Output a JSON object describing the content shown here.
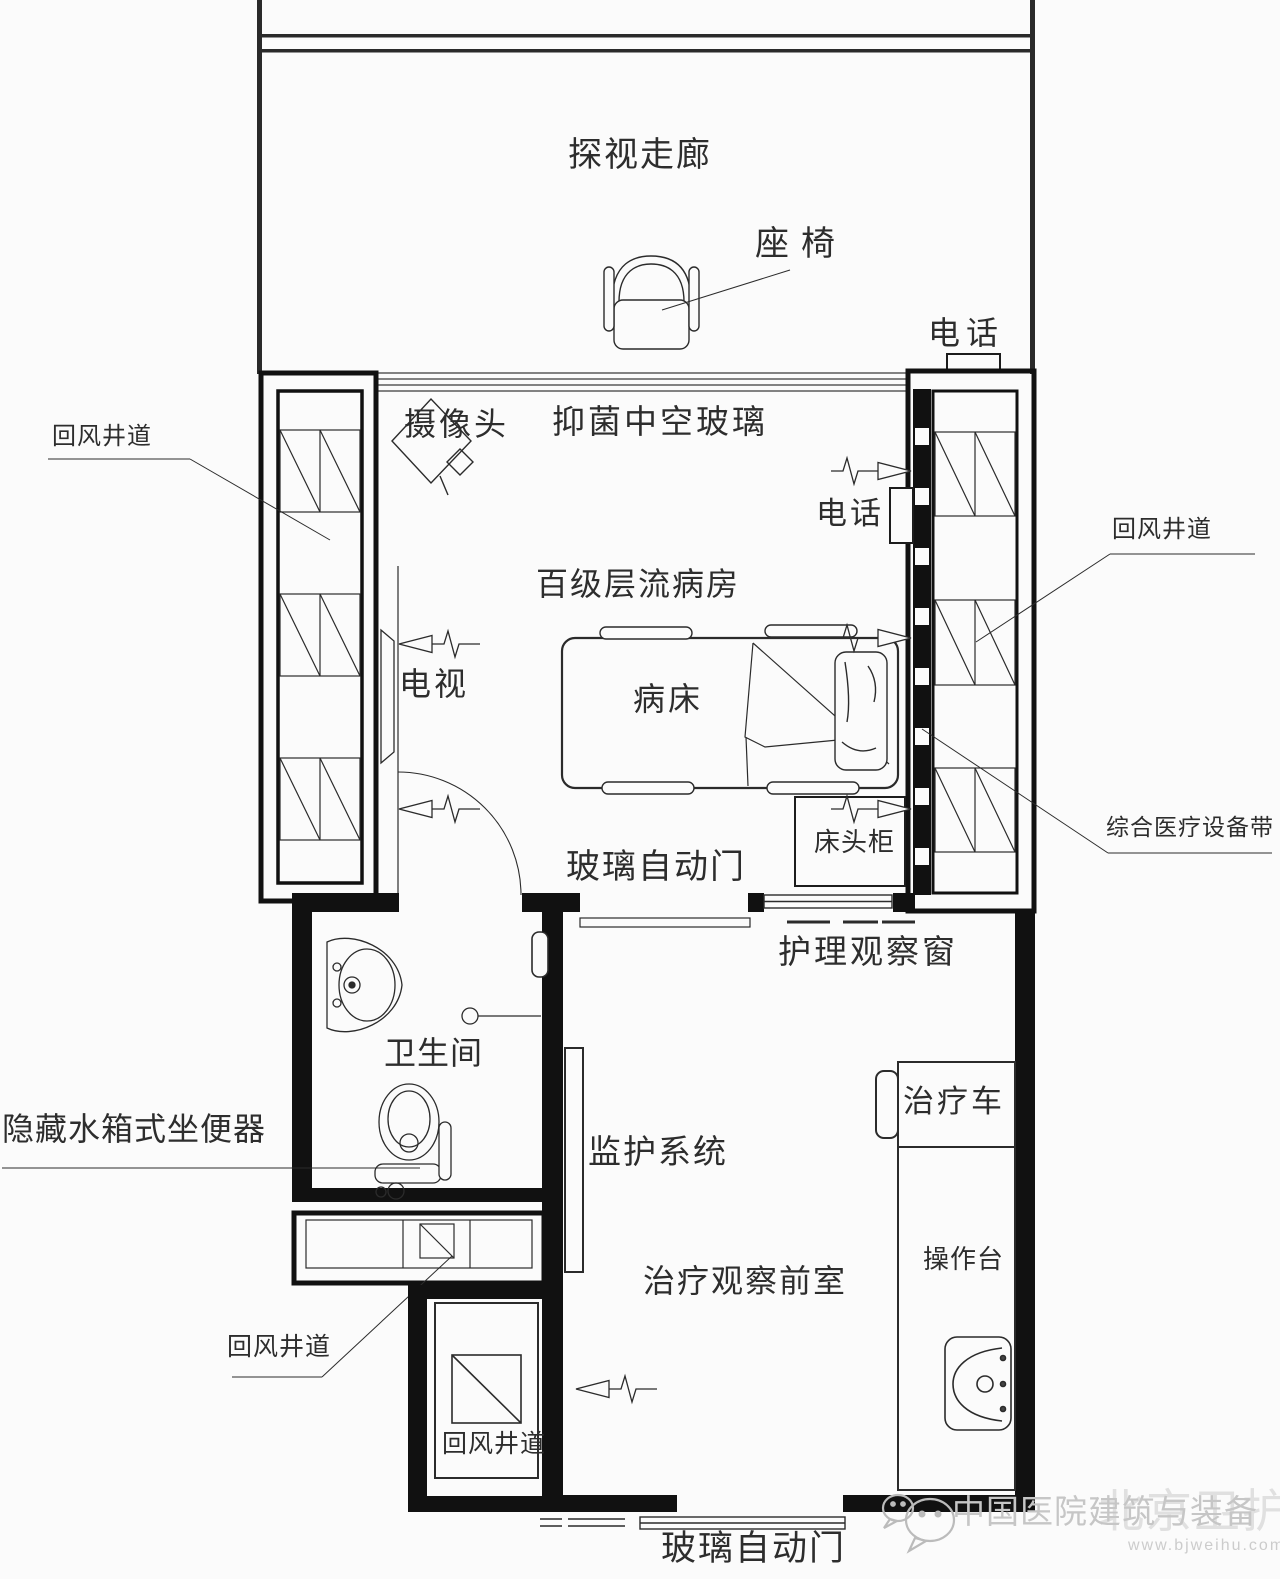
{
  "labels": {
    "corridor": "探视走廊",
    "seat": "座椅",
    "corridor_phone": "电话",
    "shaft_left": "回风井道",
    "camera": "摄像头",
    "glass": "抑菌中空玻璃",
    "room_phone": "电话",
    "ward": "百级层流病房",
    "tv": "电视",
    "bed": "病床",
    "shaft_right": "回风井道",
    "cabinet": "床头柜",
    "equipment_belt": "综合医疗设备带",
    "ward_door": "玻璃自动门",
    "observation_window": "护理观察窗",
    "bathroom": "卫生间",
    "toilet": "隐藏水箱式坐便器",
    "monitor": "监护系统",
    "anteroom": "治疗观察前室",
    "cart": "治疗车",
    "counter": "操作台",
    "shaft_bottom_callout": "回风井道",
    "shaft_bottom_room": "回风井道",
    "anteroom_door": "玻璃自动门"
  },
  "watermark": {
    "title": "中国医院建筑与装备",
    "brand": "北京卫护",
    "url": "www.bjweihu.com"
  },
  "colors": {
    "line": "#252525",
    "wall": "#111111",
    "background": "#fbfbfb",
    "watermark_text": "#c6c6c6",
    "watermark_brand": "#e0e0e0"
  }
}
